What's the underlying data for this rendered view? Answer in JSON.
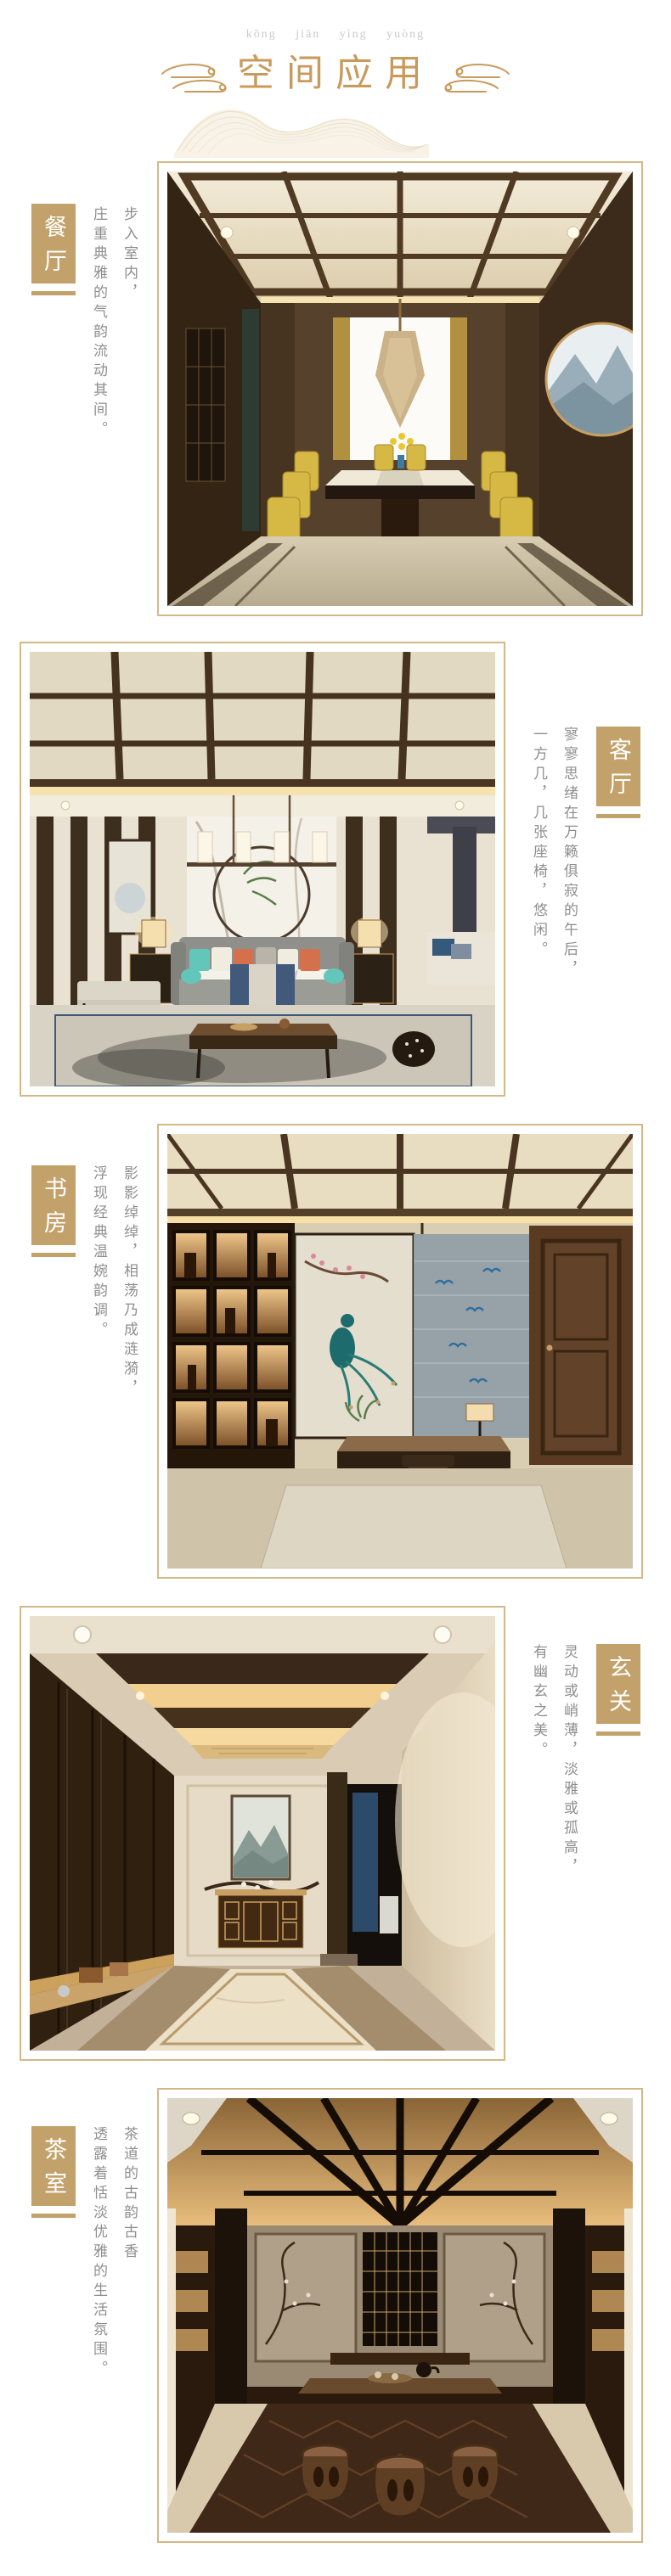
{
  "header": {
    "pinyin": "kōng jiān yìng yuòng",
    "title": "空间应用"
  },
  "colors": {
    "accent_gold": "#C2A26A",
    "title_gold": "#C89B5C",
    "frame_border": "#D5B887",
    "body_text": "#8E8E8E",
    "pinyin_gray": "#C9C9C9"
  },
  "sections": [
    {
      "id": "dining",
      "label": "餐厅",
      "photo": "dining-room-photo",
      "photo_side": "right",
      "line1": "步入室内，",
      "line2": "庄重典雅的气韵流动其间。"
    },
    {
      "id": "living",
      "label": "客厅",
      "photo": "living-room-photo",
      "photo_side": "left",
      "line1": "寥寥思绪在万籁俱寂的午后，",
      "line2": "一方几，几张座椅，悠闲。"
    },
    {
      "id": "study",
      "label": "书房",
      "photo": "study-photo",
      "photo_side": "right",
      "line1": "影影绰绰，相荡乃成涟漪，",
      "line2": "浮现经典温婉韵调。"
    },
    {
      "id": "entry",
      "label": "玄关",
      "photo": "entryway-photo",
      "photo_side": "left",
      "line1": "灵动或峭薄，淡雅或孤高，",
      "line2": "有幽玄之美。"
    },
    {
      "id": "tea",
      "label": "茶室",
      "photo": "tea-room-photo",
      "photo_side": "right",
      "line1": "茶道的古韵古香",
      "line2": "透露着恬淡优雅的生活氛围。"
    }
  ]
}
